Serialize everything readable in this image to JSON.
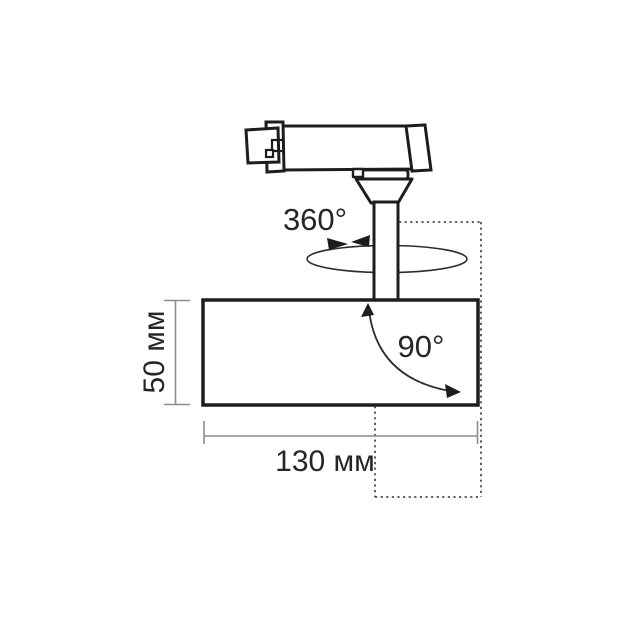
{
  "diagram": {
    "kind": "track-spotlight-dimension-drawing",
    "labels": {
      "rotation": "360°",
      "tilt": "90°",
      "height": "50 мм",
      "width": "130 мм"
    },
    "colors": {
      "outline": "#1d1d1b",
      "thin_line": "#2e2e2e",
      "dotted_line": "#4d4d4d",
      "dimension_line": "#8c8c8c",
      "text": "#262626",
      "background": "#ffffff"
    }
  }
}
